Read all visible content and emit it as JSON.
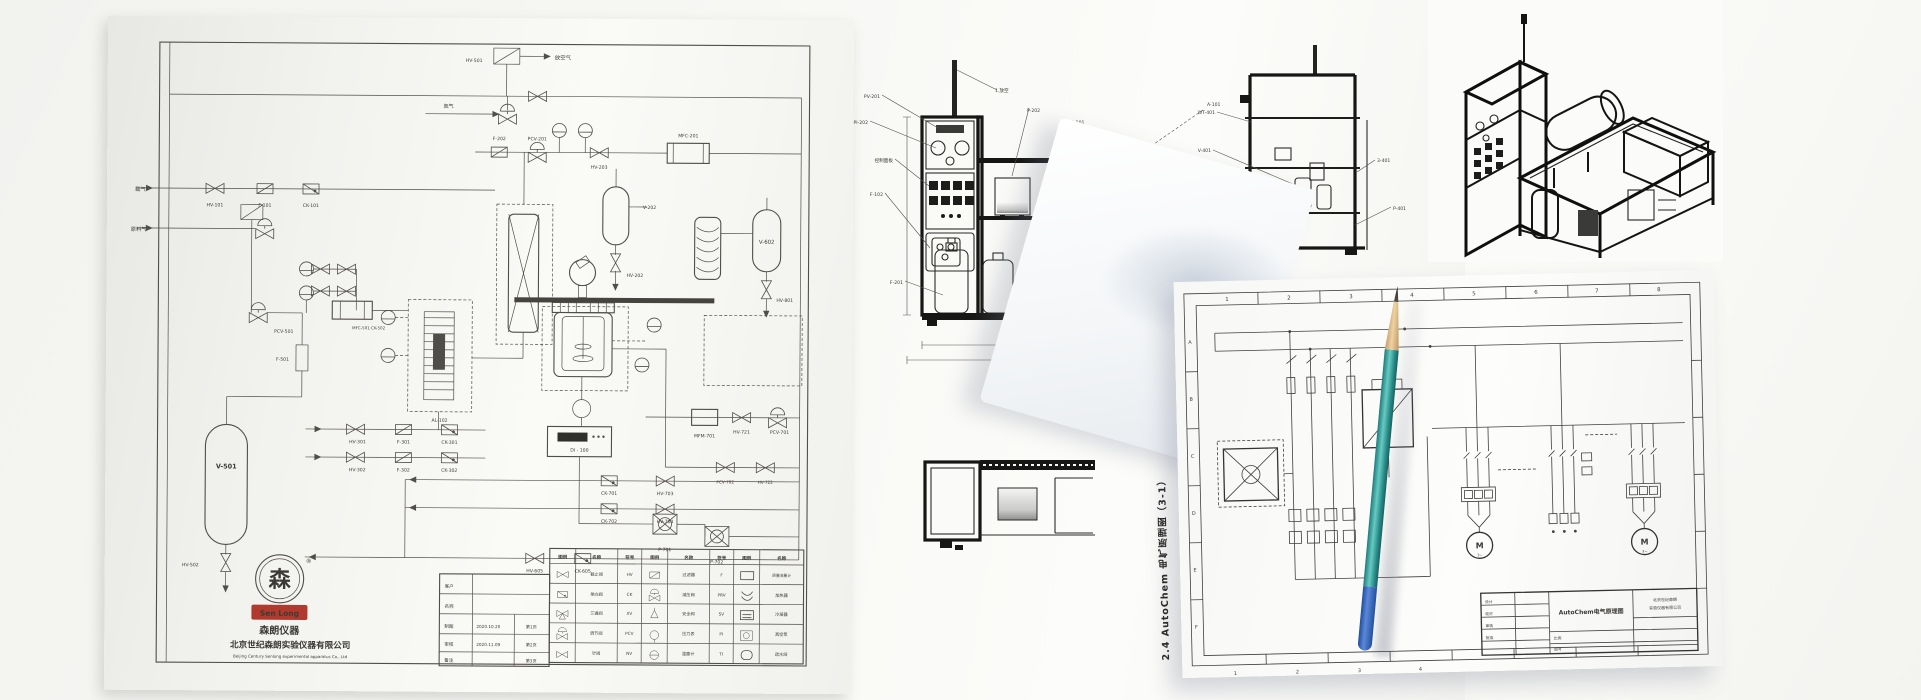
{
  "scene": {
    "description": "Photo of four overlapping engineering drawing sheets (P&ID, equipment elevations, 3D isometric, electrical schematic) with a teal pencil"
  },
  "pid": {
    "tags": [
      {
        "x": 358,
        "y": 44,
        "t": "HV-501"
      },
      {
        "x": 447,
        "y": 41,
        "t": "放空气",
        "fs": 5.4
      },
      {
        "x": 336,
        "y": 90,
        "t": "氮气",
        "fs": 5
      },
      {
        "x": 392,
        "y": 122,
        "t": "F-202",
        "a": "middle"
      },
      {
        "x": 430,
        "y": 122,
        "t": "PCV-201",
        "a": "middle"
      },
      {
        "x": 492,
        "y": 150,
        "t": "HV-203",
        "a": "middle"
      },
      {
        "x": 581,
        "y": 118,
        "t": "MFC-201",
        "a": "middle"
      },
      {
        "x": 536,
        "y": 190,
        "t": "V-202"
      },
      {
        "x": 520,
        "y": 258,
        "t": "HV-202"
      },
      {
        "x": 660,
        "y": 224,
        "t": "V-602",
        "fs": 5.4,
        "a": "middle"
      },
      {
        "x": 670,
        "y": 282,
        "t": "HV-801"
      },
      {
        "x": 28,
        "y": 175,
        "t": "载气",
        "fs": 5.4
      },
      {
        "x": 108,
        "y": 190,
        "t": "HV-101",
        "a": "middle"
      },
      {
        "x": 158,
        "y": 190,
        "t": "F-101",
        "a": "middle"
      },
      {
        "x": 204,
        "y": 190,
        "t": "CK-101",
        "a": "middle"
      },
      {
        "x": 24,
        "y": 215,
        "t": "原料气",
        "fs": 5.2
      },
      {
        "x": 168,
        "y": 316,
        "t": "PCV-501"
      },
      {
        "x": 246,
        "y": 312,
        "t": "MFC-501·CK-502",
        "fs": 4
      },
      {
        "x": 170,
        "y": 344,
        "t": "F-501"
      },
      {
        "x": 121,
        "y": 452,
        "t": "V-501",
        "fs": 6.5,
        "a": "middle",
        "b": 1
      },
      {
        "x": 94,
        "y": 550,
        "t": "HV-502",
        "a": "end"
      },
      {
        "x": 334,
        "y": 404,
        "t": "AL-102",
        "a": "middle"
      },
      {
        "x": 252,
        "y": 426,
        "t": "HV-301",
        "a": "middle"
      },
      {
        "x": 298,
        "y": 426,
        "t": "F-301",
        "a": "middle"
      },
      {
        "x": 344,
        "y": 426,
        "t": "CK-301",
        "a": "middle"
      },
      {
        "x": 252,
        "y": 454,
        "t": "HV-302",
        "a": "middle"
      },
      {
        "x": 298,
        "y": 454,
        "t": "F-302",
        "a": "middle"
      },
      {
        "x": 344,
        "y": 454,
        "t": "CK-302",
        "a": "middle"
      },
      {
        "x": 474,
        "y": 433,
        "t": "DI - 100",
        "fs": 4.6,
        "a": "middle"
      },
      {
        "x": 599,
        "y": 418,
        "t": "MFM-701",
        "a": "middle"
      },
      {
        "x": 636,
        "y": 414,
        "t": "HV-721",
        "a": "middle"
      },
      {
        "x": 674,
        "y": 414,
        "t": "PCV-701",
        "a": "middle"
      },
      {
        "x": 620,
        "y": 464,
        "t": "PCV-702",
        "a": "middle",
        "fs": 4.2
      },
      {
        "x": 660,
        "y": 464,
        "t": "HV-722",
        "a": "middle",
        "fs": 4.2
      },
      {
        "x": 504,
        "y": 476,
        "t": "CK-701",
        "a": "middle"
      },
      {
        "x": 560,
        "y": 476,
        "t": "HV-703",
        "a": "middle"
      },
      {
        "x": 504,
        "y": 504,
        "t": "CK-702",
        "a": "middle"
      },
      {
        "x": 560,
        "y": 504,
        "t": "HV-704",
        "a": "middle"
      },
      {
        "x": 560,
        "y": 532,
        "t": "P-701",
        "a": "middle"
      },
      {
        "x": 612,
        "y": 544,
        "t": "P-702",
        "a": "middle"
      },
      {
        "x": 430,
        "y": 554,
        "t": "HV-605",
        "a": "middle"
      },
      {
        "x": 478,
        "y": 554,
        "t": "CK-605",
        "a": "middle"
      }
    ],
    "block_texts": [
      {
        "x": 175,
        "y": 570,
        "t": "森",
        "fs": 22,
        "b": 1,
        "a": "middle"
      },
      {
        "x": 201,
        "y": 546,
        "t": "®",
        "fs": 6
      },
      {
        "x": 175,
        "y": 599,
        "t": "Sen Long",
        "fs": 7.5,
        "b": 1,
        "a": "middle",
        "c": "#f7ecd2"
      },
      {
        "x": 175,
        "y": 617,
        "t": "森朗仪器",
        "fs": 10,
        "b": 1,
        "a": "middle"
      },
      {
        "x": 186,
        "y": 631,
        "t": "北京世纪森朗实验仪器有限公司",
        "fs": 8.6,
        "b": 1,
        "a": "middle"
      },
      {
        "x": 186,
        "y": 641,
        "t": "Beijing Century Senlong experimental apparatus Co., Ltd",
        "fs": 4,
        "a": "middle",
        "c": "#8b8b86"
      },
      {
        "x": 340,
        "y": 570,
        "t": "客户",
        "fs": 4.6
      },
      {
        "x": 340,
        "y": 590,
        "t": "名称",
        "fs": 4.6
      },
      {
        "x": 340,
        "y": 610,
        "t": "制图",
        "fs": 4.6
      },
      {
        "x": 340,
        "y": 628,
        "t": "审核",
        "fs": 4.6
      },
      {
        "x": 340,
        "y": 644,
        "t": "备注",
        "fs": 4.6
      },
      {
        "x": 372,
        "y": 610,
        "t": "2020.10.20",
        "fs": 4.2
      },
      {
        "x": 372,
        "y": 628,
        "t": "2020.11.09",
        "fs": 4.2
      },
      {
        "x": 427,
        "y": 610,
        "t": "第1页",
        "fs": 4.2,
        "a": "middle"
      },
      {
        "x": 427,
        "y": 628,
        "t": "第2页",
        "fs": 4.2,
        "a": "middle"
      },
      {
        "x": 427,
        "y": 644,
        "t": "第3页",
        "fs": 4.2,
        "a": "middle"
      }
    ],
    "legend_texts": [
      {
        "x": 458,
        "y": 540,
        "t": "图例",
        "fs": 4.5,
        "b": 1,
        "a": "middle"
      },
      {
        "x": 492,
        "y": 540,
        "t": "名称",
        "fs": 4.5,
        "b": 1,
        "a": "middle"
      },
      {
        "x": 525,
        "y": 540,
        "t": "符号",
        "fs": 4.5,
        "b": 1,
        "a": "middle"
      },
      {
        "x": 550,
        "y": 540,
        "t": "图例",
        "fs": 4.5,
        "b": 1,
        "a": "middle"
      },
      {
        "x": 584,
        "y": 540,
        "t": "名称",
        "fs": 4.5,
        "b": 1,
        "a": "middle"
      },
      {
        "x": 617,
        "y": 540,
        "t": "符号",
        "fs": 4.5,
        "b": 1,
        "a": "middle"
      },
      {
        "x": 642,
        "y": 540,
        "t": "图例",
        "fs": 4.5,
        "b": 1,
        "a": "middle"
      },
      {
        "x": 677,
        "y": 540,
        "t": "名称",
        "fs": 4.5,
        "b": 1,
        "a": "middle"
      },
      {
        "x": 492,
        "y": 557,
        "t": "截止阀",
        "fs": 4.2,
        "a": "middle"
      },
      {
        "x": 492,
        "y": 577,
        "t": "单向阀",
        "fs": 4.2,
        "a": "middle"
      },
      {
        "x": 492,
        "y": 596,
        "t": "三通阀",
        "fs": 4.2,
        "a": "middle"
      },
      {
        "x": 492,
        "y": 616,
        "t": "调节阀",
        "fs": 4.2,
        "a": "middle"
      },
      {
        "x": 492,
        "y": 636,
        "t": "针阀",
        "fs": 4.2,
        "a": "middle"
      },
      {
        "x": 525,
        "y": 557,
        "t": "HV",
        "fs": 4.2,
        "a": "middle"
      },
      {
        "x": 525,
        "y": 577,
        "t": "CK",
        "fs": 4.2,
        "a": "middle"
      },
      {
        "x": 525,
        "y": 596,
        "t": "XV",
        "fs": 4.2,
        "a": "middle"
      },
      {
        "x": 525,
        "y": 616,
        "t": "PCV",
        "fs": 4.2,
        "a": "middle"
      },
      {
        "x": 525,
        "y": 636,
        "t": "NV",
        "fs": 4.2,
        "a": "middle"
      },
      {
        "x": 584,
        "y": 557,
        "t": "过滤器",
        "fs": 4.2,
        "a": "middle"
      },
      {
        "x": 584,
        "y": 577,
        "t": "减压阀",
        "fs": 4.2,
        "a": "middle"
      },
      {
        "x": 584,
        "y": 596,
        "t": "安全阀",
        "fs": 4.2,
        "a": "middle"
      },
      {
        "x": 584,
        "y": 616,
        "t": "压力表",
        "fs": 4.2,
        "a": "middle"
      },
      {
        "x": 584,
        "y": 636,
        "t": "温度计",
        "fs": 4.2,
        "a": "middle"
      },
      {
        "x": 617,
        "y": 557,
        "t": "F",
        "fs": 4.2,
        "a": "middle"
      },
      {
        "x": 617,
        "y": 577,
        "t": "PRV",
        "fs": 4.2,
        "a": "middle"
      },
      {
        "x": 617,
        "y": 596,
        "t": "SV",
        "fs": 4.2,
        "a": "middle"
      },
      {
        "x": 617,
        "y": 616,
        "t": "PI",
        "fs": 4.2,
        "a": "middle"
      },
      {
        "x": 617,
        "y": 636,
        "t": "TI",
        "fs": 4.2,
        "a": "middle"
      },
      {
        "x": 677,
        "y": 557,
        "t": "质量流量计",
        "fs": 3.8,
        "a": "middle"
      },
      {
        "x": 677,
        "y": 577,
        "t": "加热器",
        "fs": 4.2,
        "a": "middle"
      },
      {
        "x": 677,
        "y": 596,
        "t": "冷凝器",
        "fs": 4.2,
        "a": "middle"
      },
      {
        "x": 677,
        "y": 616,
        "t": "真空泵",
        "fs": 4.2,
        "a": "middle"
      },
      {
        "x": 677,
        "y": 636,
        "t": "疏水阀",
        "fs": 4.2,
        "a": "middle"
      }
    ]
  },
  "elev": {
    "labels": [
      {
        "x": 225,
        "y": 98,
        "t": "PV-201",
        "a": "end"
      },
      {
        "x": 213,
        "y": 124,
        "t": "PI-202",
        "a": "end"
      },
      {
        "x": 238,
        "y": 162,
        "t": "控制面板",
        "a": "end"
      },
      {
        "x": 228,
        "y": 196,
        "t": "F-102",
        "a": "end"
      },
      {
        "x": 340,
        "y": 92,
        "t": "1.放空"
      },
      {
        "x": 372,
        "y": 112,
        "t": "P-202"
      },
      {
        "x": 412,
        "y": 124,
        "t": "HD-101"
      },
      {
        "x": 552,
        "y": 106,
        "t": "A-101"
      },
      {
        "x": 248,
        "y": 284,
        "t": "F-201",
        "a": "end"
      },
      {
        "x": 560,
        "y": 114,
        "t": "WT-401",
        "a": "end"
      },
      {
        "x": 556,
        "y": 152,
        "t": "V-401",
        "a": "end"
      },
      {
        "x": 556,
        "y": 192,
        "t": "XV-401",
        "a": "end"
      },
      {
        "x": 722,
        "y": 162,
        "t": "3-401"
      },
      {
        "x": 738,
        "y": 210,
        "t": "P-401"
      }
    ]
  },
  "electric": {
    "caption": "2.4 AutoChem 电气原理图（3-1）",
    "grid_labels": [
      {
        "x": 53,
        "y": 20,
        "t": "1",
        "fs": 5.5,
        "a": "middle"
      },
      {
        "x": 115,
        "y": 20,
        "t": "2",
        "fs": 5.5,
        "a": "middle"
      },
      {
        "x": 177,
        "y": 20,
        "t": "3",
        "fs": 5.5,
        "a": "middle"
      },
      {
        "x": 238,
        "y": 20,
        "t": "4",
        "fs": 5.5,
        "a": "middle"
      },
      {
        "x": 300,
        "y": 20,
        "t": "5",
        "fs": 5.5,
        "a": "middle"
      },
      {
        "x": 362,
        "y": 20,
        "t": "6",
        "fs": 5.5,
        "a": "middle"
      },
      {
        "x": 423,
        "y": 20,
        "t": "7",
        "fs": 5.5,
        "a": "middle"
      },
      {
        "x": 485,
        "y": 20,
        "t": "8",
        "fs": 5.5,
        "a": "middle"
      },
      {
        "x": 15,
        "y": 62,
        "t": "A",
        "fs": 5,
        "a": "middle"
      },
      {
        "x": 15,
        "y": 119,
        "t": "B",
        "fs": 5,
        "a": "middle"
      },
      {
        "x": 15,
        "y": 176,
        "t": "C",
        "fs": 5,
        "a": "middle"
      },
      {
        "x": 15,
        "y": 233,
        "t": "D",
        "fs": 5,
        "a": "middle"
      },
      {
        "x": 15,
        "y": 290,
        "t": "E",
        "fs": 5,
        "a": "middle"
      },
      {
        "x": 15,
        "y": 347,
        "t": "F",
        "fs": 5,
        "a": "middle"
      },
      {
        "x": 53,
        "y": 394,
        "t": "1",
        "fs": 5,
        "a": "middle"
      },
      {
        "x": 115,
        "y": 394,
        "t": "2",
        "fs": 5,
        "a": "middle"
      },
      {
        "x": 177,
        "y": 394,
        "t": "3",
        "fs": 5,
        "a": "middle"
      },
      {
        "x": 238,
        "y": 394,
        "t": "4",
        "fs": 5,
        "a": "middle"
      }
    ],
    "labels": [
      {
        "x": 300,
        "y": 273,
        "t": "M",
        "fs": 8,
        "b": 1,
        "a": "middle"
      },
      {
        "x": 300,
        "y": 281,
        "t": "3~",
        "fs": 3.6,
        "a": "middle"
      },
      {
        "x": 465,
        "y": 273,
        "t": "M",
        "fs": 8,
        "b": 1,
        "a": "middle"
      },
      {
        "x": 465,
        "y": 281,
        "t": "3~",
        "fs": 3.6,
        "a": "middle"
      },
      {
        "x": 410,
        "y": 341,
        "t": "AutoChem电气原理图",
        "fs": 6,
        "b": 1,
        "a": "middle"
      },
      {
        "x": 484,
        "y": 330,
        "t": "北京世纪森朗",
        "fs": 4,
        "a": "middle"
      },
      {
        "x": 484,
        "y": 338,
        "t": "实验仪器有限公司",
        "fs": 4,
        "a": "middle"
      },
      {
        "x": 304,
        "y": 328,
        "t": "设计",
        "fs": 3.8
      },
      {
        "x": 304,
        "y": 340,
        "t": "校对",
        "fs": 3.8
      },
      {
        "x": 304,
        "y": 352,
        "t": "审核",
        "fs": 3.8
      },
      {
        "x": 304,
        "y": 364,
        "t": "批准",
        "fs": 3.8
      },
      {
        "x": 372,
        "y": 366,
        "t": "比例",
        "fs": 3.8
      },
      {
        "x": 372,
        "y": 377,
        "t": "图号",
        "fs": 3.8
      }
    ]
  }
}
